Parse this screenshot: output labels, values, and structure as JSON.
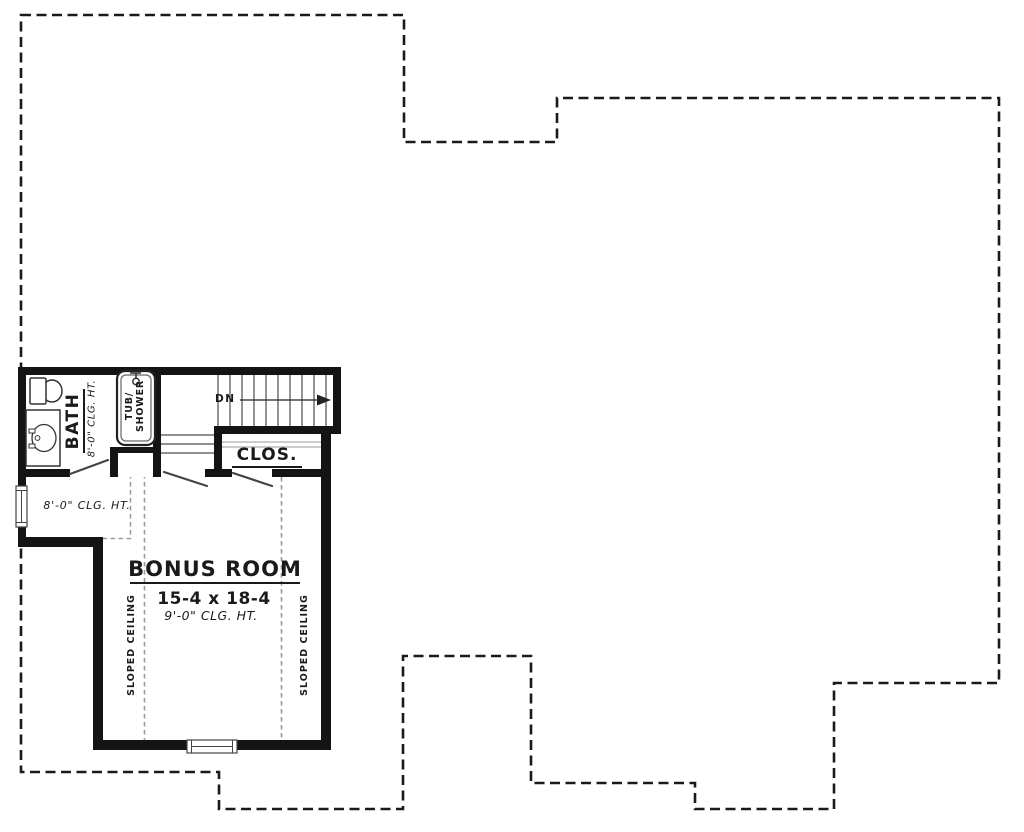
{
  "rooms": {
    "bath": {
      "name": "BATH",
      "ceiling_height": "8'-0\" CLG. HT."
    },
    "closet": {
      "name": "CLOS."
    },
    "hall": {
      "ceiling_height": "8'-0\" CLG. HT."
    },
    "bonus_room": {
      "name": "BONUS ROOM",
      "dimensions": "15-4 x 18-4",
      "ceiling_height": "9'-0\" CLG. HT."
    }
  },
  "fixtures": {
    "tub_label_line1": "TUB/",
    "tub_label_line2": "SHOWER"
  },
  "stairs": {
    "direction_label": "DN"
  },
  "annotations": {
    "sloped_ceiling_left": "SLOPED CEILING",
    "sloped_ceiling_right": "SLOPED CEILING"
  },
  "colors": {
    "background": "#ffffff",
    "walls": "#141414",
    "roof_outline": "#1a1a1a",
    "fixture_stroke": "#333333",
    "stair_lines": "#4d4d4d",
    "sloped_ceiling_dash": "#9a9a9a"
  }
}
